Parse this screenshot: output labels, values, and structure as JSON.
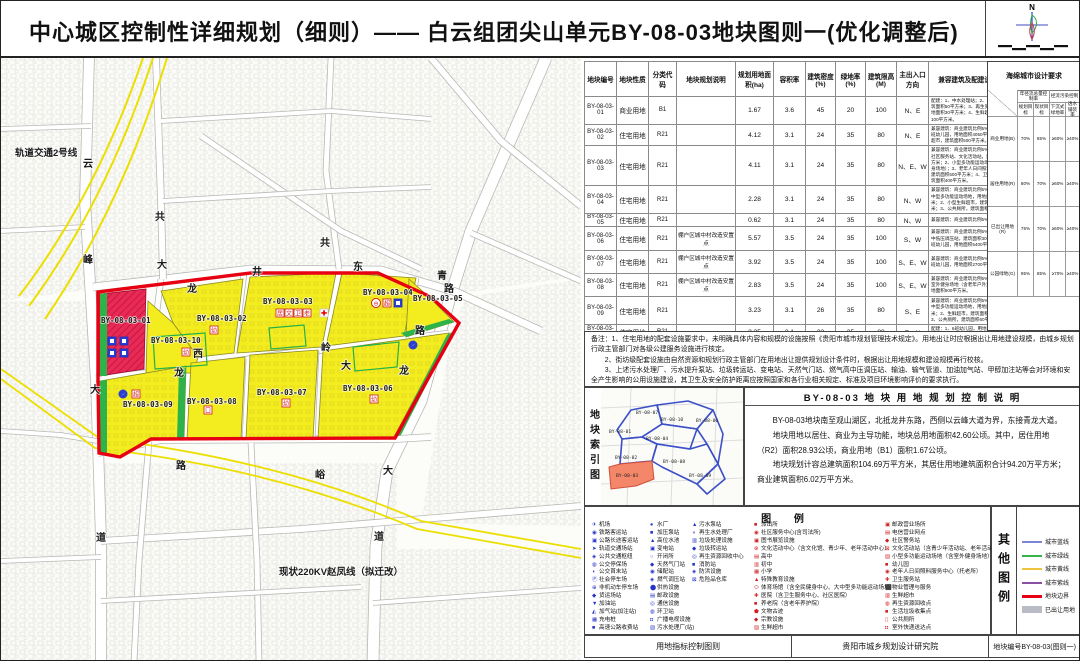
{
  "title": "中心城区控制性详细规划（细则）——  白云组团尖山单元BY-08-03地块图则一(优化调整后)",
  "compass": {
    "north_label": "N"
  },
  "table": {
    "headers": [
      "地块编号",
      "地块性质",
      "分类代码",
      "地块规划说明",
      "规划用地面积(ha)",
      "容积率",
      "建筑密度(%)",
      "绿地率(%)",
      "建筑限高(M)",
      "主出入口方向",
      "兼容建筑及配建设施要求"
    ],
    "sponge_header": "海绵城市设计要求",
    "rows": [
      {
        "h": 18,
        "code": "BY-08-03-01",
        "nature": "商业用地",
        "cls": "B1",
        "note": "",
        "area": "1.67",
        "far": "3.6",
        "density": "45",
        "green": "20",
        "height": "100",
        "entrance": "N、E",
        "require": "配建：1、中水处理站；2、公共厕所，建筑面积50平方米；3、再生资源回收点，用地面积30平方米；4、生鲜超市，建筑面积100平方米。"
      },
      {
        "h": 18,
        "code": "BY-08-03-02",
        "nature": "住宅用地",
        "cls": "R21",
        "note": "",
        "area": "4.12",
        "far": "3.1",
        "density": "24",
        "green": "35",
        "height": "80",
        "entrance": "N、E",
        "require": "兼容建筑：商业建筑比例5%。配建：1、9班幼儿园，用地面积4050平方米；2、生鲜超市，建筑面积500平方米。"
      },
      {
        "h": 30,
        "code": "BY-08-03-03",
        "nature": "住宅用地",
        "cls": "R21",
        "note": "",
        "area": "4.11",
        "far": "3.1",
        "density": "24",
        "green": "35",
        "height": "80",
        "entrance": "N、E、W",
        "require": "兼容建筑：商业建筑比例5%。配建：1、社区服务站、文化活动站，建筑面积800平方米；2、小型多功能运动场地（含室外健身场地）；3、老年人日间照料服务中心，建筑面积500平方米；4、卫生服务站，建筑面积400平方米。"
      },
      {
        "h": 25,
        "code": "BY-08-03-04",
        "nature": "住宅用地",
        "cls": "R21",
        "note": "",
        "area": "2.28",
        "far": "3.1",
        "density": "24",
        "green": "35",
        "height": "80",
        "entrance": "N、W",
        "require": "兼容建筑：商业建筑比例5%。配建：1、中型多功能运动场地，用地面积1300平方米；2、小型生鲜超市，建筑面积300平方米；3、公共厕所，建筑面积60平方米。"
      },
      {
        "h": 13,
        "code": "BY-08-03-05",
        "nature": "住宅用地",
        "cls": "R21",
        "note": "",
        "area": "0.62",
        "far": "3.1",
        "density": "24",
        "green": "35",
        "height": "80",
        "entrance": "N、W",
        "require": "兼容建筑：商业建筑比例5%。"
      },
      {
        "h": 24,
        "code": "BY-08-03-06",
        "nature": "住宅用地",
        "cls": "R21",
        "note": "棚户区城中村改造安置点",
        "area": "5.57",
        "far": "3.5",
        "density": "24",
        "green": "35",
        "height": "100",
        "entrance": "S、W",
        "require": "兼容建筑：商业建筑比例5%。配建：1、中低压调压站，建筑面积30平方米；2、12班幼儿园，用地面积5400平方米。"
      },
      {
        "h": 23,
        "code": "BY-08-03-07",
        "nature": "住宅用地",
        "cls": "R21",
        "note": "棚户区城中村改造安置点",
        "area": "3.92",
        "far": "3.5",
        "density": "24",
        "green": "35",
        "height": "100",
        "entrance": "S、E、W",
        "require": "兼容建筑：商业建筑比例5%。配建：1、6班幼儿园，用地面积2700平方米。"
      },
      {
        "h": 23,
        "code": "BY-08-03-08",
        "nature": "住宅用地",
        "cls": "R21",
        "note": "棚户区城中村改造安置点",
        "area": "2.83",
        "far": "3.5",
        "density": "24",
        "green": "35",
        "height": "100",
        "entrance": "S、E、W",
        "require": "兼容建筑：商业建筑比例5%。配建：1、室外健身场地（含老年户外活动场地），用地面积500平方米。"
      },
      {
        "h": 22,
        "code": "BY-08-03-09",
        "nature": "住宅用地",
        "cls": "R21",
        "note": "",
        "area": "3.23",
        "far": "3.1",
        "density": "26",
        "green": "35",
        "height": "80",
        "entrance": "S、E",
        "require": "兼容建筑：商业建筑比例5%。配建：1、中型多功能运动场地，用地面积1300平方米；2、生鲜超市，建筑面积300平方米；3、公共厕所，建筑面积60平方米。"
      },
      {
        "h": 16,
        "code": "BY-08-03-10",
        "nature": "住宅用地",
        "cls": "R21",
        "note": "",
        "area": "2.25",
        "far": "3.1",
        "density": "22",
        "green": "35",
        "height": "80",
        "entrance": "E、N",
        "require": "配建：1、6班幼儿园，用地面积2430平方米。"
      }
    ]
  },
  "sponge": {
    "corner": "用地类别",
    "groups": [
      "年径流总量控制率",
      "径流污染控制"
    ],
    "subs": [
      "规划目标",
      "现状目标",
      "下沉式绿地率",
      "透水铺装率"
    ],
    "rows": [
      {
        "label": "商业用地(B)",
        "v": [
          "70%",
          "65%",
          "≥60%",
          "≥40%"
        ]
      },
      {
        "label": "居住用地(R)",
        "v": [
          "80%",
          "70%",
          "≥60%",
          "≥40%"
        ]
      },
      {
        "label": "已出让用地(R)",
        "v": [
          "75%",
          "70%",
          "≥60%",
          "≥40%"
        ]
      },
      {
        "label": "公园绿地(G)",
        "v": [
          "95%",
          "85%",
          "≥70%",
          "≥40%"
        ]
      }
    ]
  },
  "notes": {
    "lines": [
      "备注：1、住宅用地的配套设施要求中，未明确具体内容和规模的设施按照《贵阳市城市规划管理技术规定》。用地出让时应根据出让用地建设规模，由城乡规划行政主管部门对各级公建服务设施进行核定。",
      "　　2、街坊级配套设施由自然资源和规划行政主管部门在用地出让提供规划设计条件时，根据出让用地规模和建设规模再行校核。",
      "　　3、上述污水处理厂、污水提升泵站、垃圾转运站、变电站、天然气门站、燃气高中压调压站、输油、输气管道、加油加气站、甲醇加注站等会对环境和安全产生影响的公用设施建设，其卫生及安全防护距离应按照国家和各行业相关规定、标准及项目环境影响评价的要求执行。"
    ]
  },
  "index_map": {
    "side_label": "地块索引图",
    "labels": [
      {
        "t": "BY-08-07",
        "x": 35,
        "y": 26
      },
      {
        "t": "BY-08-10",
        "x": 60,
        "y": 33
      },
      {
        "t": "BY-08-06",
        "x": 95,
        "y": 34
      },
      {
        "t": "BY-08-01",
        "x": 8,
        "y": 45
      },
      {
        "t": "BY-08-04",
        "x": 45,
        "y": 52
      },
      {
        "t": "BY-08-02",
        "x": 14,
        "y": 71
      },
      {
        "t": "BY-08-08",
        "x": 62,
        "y": 75
      },
      {
        "t": "BY-08-09",
        "x": 88,
        "y": 89
      },
      {
        "t": "BY-08-03",
        "x": 15,
        "y": 89
      }
    ]
  },
  "description": {
    "title": "BY-08-03 地 块 用 地 规 划 控 制 说 明",
    "paragraphs": [
      "BY-08-03地块南至观山湖区，北抵龙井东路，西侧以云峰大道为界，东接青龙大道。",
      "地块用地以居住、商业为主导功能，地块总用地面积42.60公顷。其中，居住用地（R2）面积28.93公顷，商业用地（B1）面积1.67公顷。",
      "地块规划计容总建筑面积104.69万平方米，其居住用地建筑面积合计94.20万平方米；商业建筑面积6.02万平方米。"
    ]
  },
  "legend": {
    "title": "图  例",
    "columns": [
      {
        "items": [
          {
            "g": "✈",
            "t": "机场"
          },
          {
            "g": "◉",
            "t": "铁路客运站"
          },
          {
            "g": "▣",
            "t": "公路长途客运站"
          },
          {
            "g": "➤",
            "t": "轨道交通场站"
          },
          {
            "g": "◈",
            "t": "公共交通枢纽"
          },
          {
            "g": "◍",
            "t": "公交停保场"
          },
          {
            "g": "◖",
            "t": "公交首末站"
          },
          {
            "g": "Ⓟ",
            "t": "社会停车场"
          },
          {
            "g": "⊕",
            "t": "非机动车停车场"
          },
          {
            "g": "◆",
            "t": "货运场站"
          },
          {
            "g": "▼",
            "t": "加油站"
          },
          {
            "g": "◭",
            "t": "加气站(加注站)"
          },
          {
            "g": "▦",
            "t": "充电桩"
          },
          {
            "g": "■",
            "t": "高速公路收费站"
          }
        ]
      },
      {
        "items": [
          {
            "g": "●",
            "t": "水厂"
          },
          {
            "g": "■",
            "t": "加压泵站"
          },
          {
            "g": "▲",
            "t": "高位水池"
          },
          {
            "g": "▣",
            "t": "变电站"
          },
          {
            "g": "○",
            "t": "开闭所"
          },
          {
            "g": "◆",
            "t": "天然气门站"
          },
          {
            "g": "◉",
            "t": "储配站"
          },
          {
            "g": "◈",
            "t": "燃气调压站"
          },
          {
            "g": "⬤",
            "t": "供热设施"
          },
          {
            "g": "▤",
            "t": "邮政设施"
          },
          {
            "g": "◎",
            "t": "通信设施"
          },
          {
            "g": "◍",
            "t": "环卫站"
          },
          {
            "g": "◘",
            "t": "广播电视设施"
          },
          {
            "g": "▧",
            "t": "污水处理厂(站)"
          }
        ]
      },
      {
        "items": [
          {
            "g": "▲",
            "t": "污水泵站"
          },
          {
            "g": "◑",
            "t": "再生水处理厂"
          },
          {
            "g": "▥",
            "t": "垃圾处理设施"
          },
          {
            "g": "◆",
            "t": "垃圾转运站"
          },
          {
            "g": "◎",
            "t": "再生资源回收中心"
          },
          {
            "g": "■",
            "t": "消防站"
          },
          {
            "g": "◈",
            "t": "防洪设施"
          },
          {
            "g": "⊠",
            "t": "危险品仓库"
          }
        ]
      },
      {
        "items": [
          {
            "g": "■",
            "t": "派出所"
          },
          {
            "g": "◉",
            "t": "社区服务中心(含司法所)"
          },
          {
            "g": "▣",
            "t": "图书展览设施"
          },
          {
            "g": "⊗",
            "t": "文化活动中心（含文化馆、青少年、老年活动中心）"
          },
          {
            "g": "▤",
            "t": "高中"
          },
          {
            "g": "▥",
            "t": "初中"
          },
          {
            "g": "▦",
            "t": "小学"
          },
          {
            "g": "▲",
            "t": "特殊教育设施"
          },
          {
            "g": "⬭",
            "t": "体育场馆（含全民健身中心、大中型多功能运动场地）"
          },
          {
            "g": "✚",
            "t": "医院（含卫生服务中心、社区医院）"
          },
          {
            "g": "■",
            "t": "养老院（含老年养护院）"
          },
          {
            "g": "⬟",
            "t": "文物古迹"
          },
          {
            "g": "◆",
            "t": "宗教设施"
          },
          {
            "g": "▨",
            "t": "生鲜超市"
          }
        ]
      },
      {
        "items": [
          {
            "g": "▣",
            "t": "邮政营业场所"
          },
          {
            "g": "▤",
            "t": "电信营业网点"
          },
          {
            "g": "◆",
            "t": "社区警务站"
          },
          {
            "g": "⊠",
            "t": "文化活动站（含青少年活动站、老年活动站）"
          },
          {
            "g": "▨",
            "t": "小型多功能运动场地（含室外健身场地）"
          },
          {
            "g": "■",
            "t": "幼儿园"
          },
          {
            "g": "◉",
            "t": "老年人日间照料服务中心（托老所）"
          },
          {
            "g": "✚",
            "t": "卫生服务站"
          },
          {
            "g": "⬛",
            "t": "物业管理与服务"
          },
          {
            "g": "▥",
            "t": "生鲜超市"
          },
          {
            "g": "◍",
            "t": "再生资源回收点"
          },
          {
            "g": "■",
            "t": "生活垃圾收集点"
          },
          {
            "g": "▯",
            "t": "公共厕所"
          },
          {
            "g": "◘",
            "t": "室外快递送达点"
          }
        ]
      }
    ]
  },
  "other_legend": {
    "side_label": "其他图例",
    "items": [
      {
        "label": "城市蓝线",
        "color": "#7b86d8",
        "type": "line"
      },
      {
        "label": "城市绿线",
        "color": "#35b44a",
        "type": "line"
      },
      {
        "label": "城市黄线",
        "color": "#f0c33c",
        "type": "line"
      },
      {
        "label": "城市紫线",
        "color": "#8a4f9e",
        "type": "line"
      },
      {
        "label": "地块边界",
        "color": "#e60012",
        "type": "line-thick"
      },
      {
        "label": "已出让用地",
        "color": "#b9bcc4",
        "type": "fill"
      }
    ]
  },
  "footer": {
    "left": "用地指标控制图则",
    "center": "贵阳市城乡规划设计研究院",
    "right": "地块编号BY-08-03(图则一)"
  },
  "map": {
    "rail_label": {
      "t": "轨道交通2号线",
      "x": 14,
      "y": 155
    },
    "power_label": {
      "t": "现状220KV赵凤线（拟迁改）",
      "x": 278,
      "y": 574
    },
    "road_chars": [
      {
        "t": "云",
        "x": 82,
        "y": 166
      },
      {
        "t": "峰",
        "x": 82,
        "y": 262
      },
      {
        "t": "大",
        "x": 89,
        "y": 392
      },
      {
        "t": "道",
        "x": 95,
        "y": 540
      },
      {
        "t": "共",
        "x": 154,
        "y": 219
      },
      {
        "t": "大",
        "x": 156,
        "y": 267
      },
      {
        "t": "龙",
        "x": 186,
        "y": 291
      },
      {
        "t": "井",
        "x": 251,
        "y": 274
      },
      {
        "t": "东",
        "x": 352,
        "y": 269
      },
      {
        "t": "路",
        "x": 443,
        "y": 291
      },
      {
        "t": "共",
        "x": 319,
        "y": 245
      },
      {
        "t": "青",
        "x": 436,
        "y": 278
      },
      {
        "t": "西",
        "x": 192,
        "y": 356
      },
      {
        "t": "岭",
        "x": 320,
        "y": 350
      },
      {
        "t": "大",
        "x": 340,
        "y": 368
      },
      {
        "t": "龙",
        "x": 173,
        "y": 375
      },
      {
        "t": "路",
        "x": 414,
        "y": 333
      },
      {
        "t": "龙",
        "x": 398,
        "y": 373
      },
      {
        "t": "路",
        "x": 175,
        "y": 468
      },
      {
        "t": "峪",
        "x": 314,
        "y": 477
      },
      {
        "t": "大",
        "x": 382,
        "y": 473
      },
      {
        "t": "道",
        "x": 373,
        "y": 539
      }
    ],
    "parcel_labels": [
      {
        "t": "BY-08-03-01",
        "x": 100,
        "y": 322
      },
      {
        "t": "BY-08-03-02",
        "x": 196,
        "y": 320
      },
      {
        "t": "BY-08-03-03",
        "x": 262,
        "y": 303
      },
      {
        "t": "BY-08-03-04",
        "x": 362,
        "y": 294
      },
      {
        "t": "BY-08-03-05",
        "x": 412,
        "y": 300
      },
      {
        "t": "BY-08-03-06",
        "x": 342,
        "y": 390
      },
      {
        "t": "BY-08-03-07",
        "x": 256,
        "y": 394
      },
      {
        "t": "BY-08-03-08",
        "x": 186,
        "y": 403
      },
      {
        "t": "BY-08-03-09",
        "x": 122,
        "y": 406
      },
      {
        "t": "BY-08-03-10",
        "x": 150,
        "y": 342
      }
    ],
    "facility_icons": [
      {
        "type": "bb",
        "x": 111,
        "y": 340
      },
      {
        "type": "bb",
        "x": 123,
        "y": 340
      },
      {
        "type": "bb",
        "x": 111,
        "y": 352
      },
      {
        "type": "bb",
        "x": 123,
        "y": 352
      },
      {
        "type": "rb",
        "g": "幼",
        "x": 185,
        "y": 351
      },
      {
        "type": "rb",
        "g": "幼",
        "x": 213,
        "y": 329
      },
      {
        "type": "rb",
        "g": "居",
        "x": 279,
        "y": 312
      },
      {
        "type": "rb",
        "g": "文",
        "x": 288,
        "y": 312
      },
      {
        "type": "rb",
        "g": "卫",
        "x": 297,
        "y": 312
      },
      {
        "type": "rb",
        "g": "老",
        "x": 306,
        "y": 312
      },
      {
        "type": "cross",
        "x": 323,
        "y": 312
      },
      {
        "type": "rc",
        "g": "⊖",
        "x": 375,
        "y": 302
      },
      {
        "type": "rb",
        "g": "超",
        "x": 386,
        "y": 302
      },
      {
        "type": "bb",
        "x": 397,
        "y": 302
      },
      {
        "type": "rb",
        "g": "幼",
        "x": 373,
        "y": 398
      },
      {
        "type": "rb",
        "g": "幼",
        "x": 285,
        "y": 402
      },
      {
        "type": "rb",
        "g": "口",
        "x": 207,
        "y": 409
      },
      {
        "type": "bc",
        "x": 122,
        "y": 393
      },
      {
        "type": "rb",
        "g": "超",
        "x": 135,
        "y": 393
      },
      {
        "type": "bc",
        "x": 412,
        "y": 344
      }
    ]
  }
}
